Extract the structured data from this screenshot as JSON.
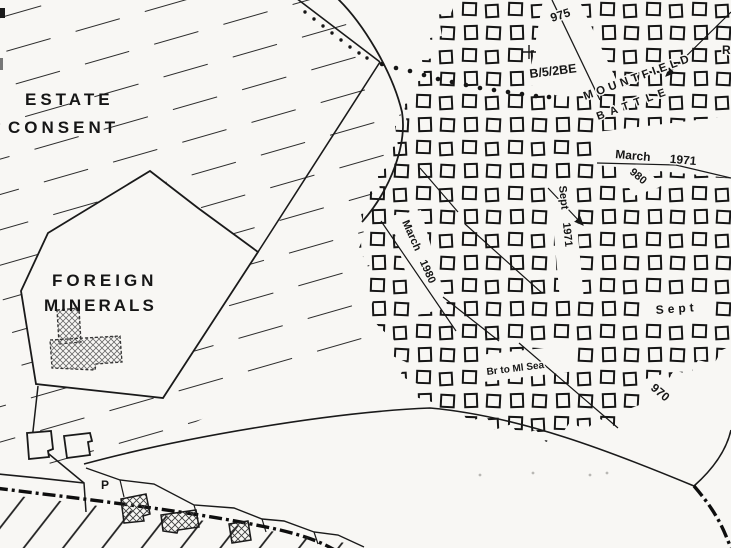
{
  "map": {
    "colors": {
      "paper": "#f8f7f4",
      "ink": "#1a1a1a"
    },
    "labels": {
      "estate_line1": "ESTATE",
      "estate_line2": "CONSENT",
      "foreign_line1": "FOREIGN",
      "foreign_line2": "MINERALS",
      "plot_975": "975",
      "ref_code": "B/5/2BE",
      "parish_mountfield": "MOUNTFIELD",
      "parish_battle": "BATTLE",
      "date_march_1971": "March 1971",
      "num_980": "980",
      "date_sept_1971": "Sept 1971",
      "date_march_1980": "March 1980",
      "date_sept": "Sept",
      "note_sea": "Br to Ml Sea",
      "num_970": "970",
      "letter_p": "P",
      "fragment_r": "R"
    }
  }
}
